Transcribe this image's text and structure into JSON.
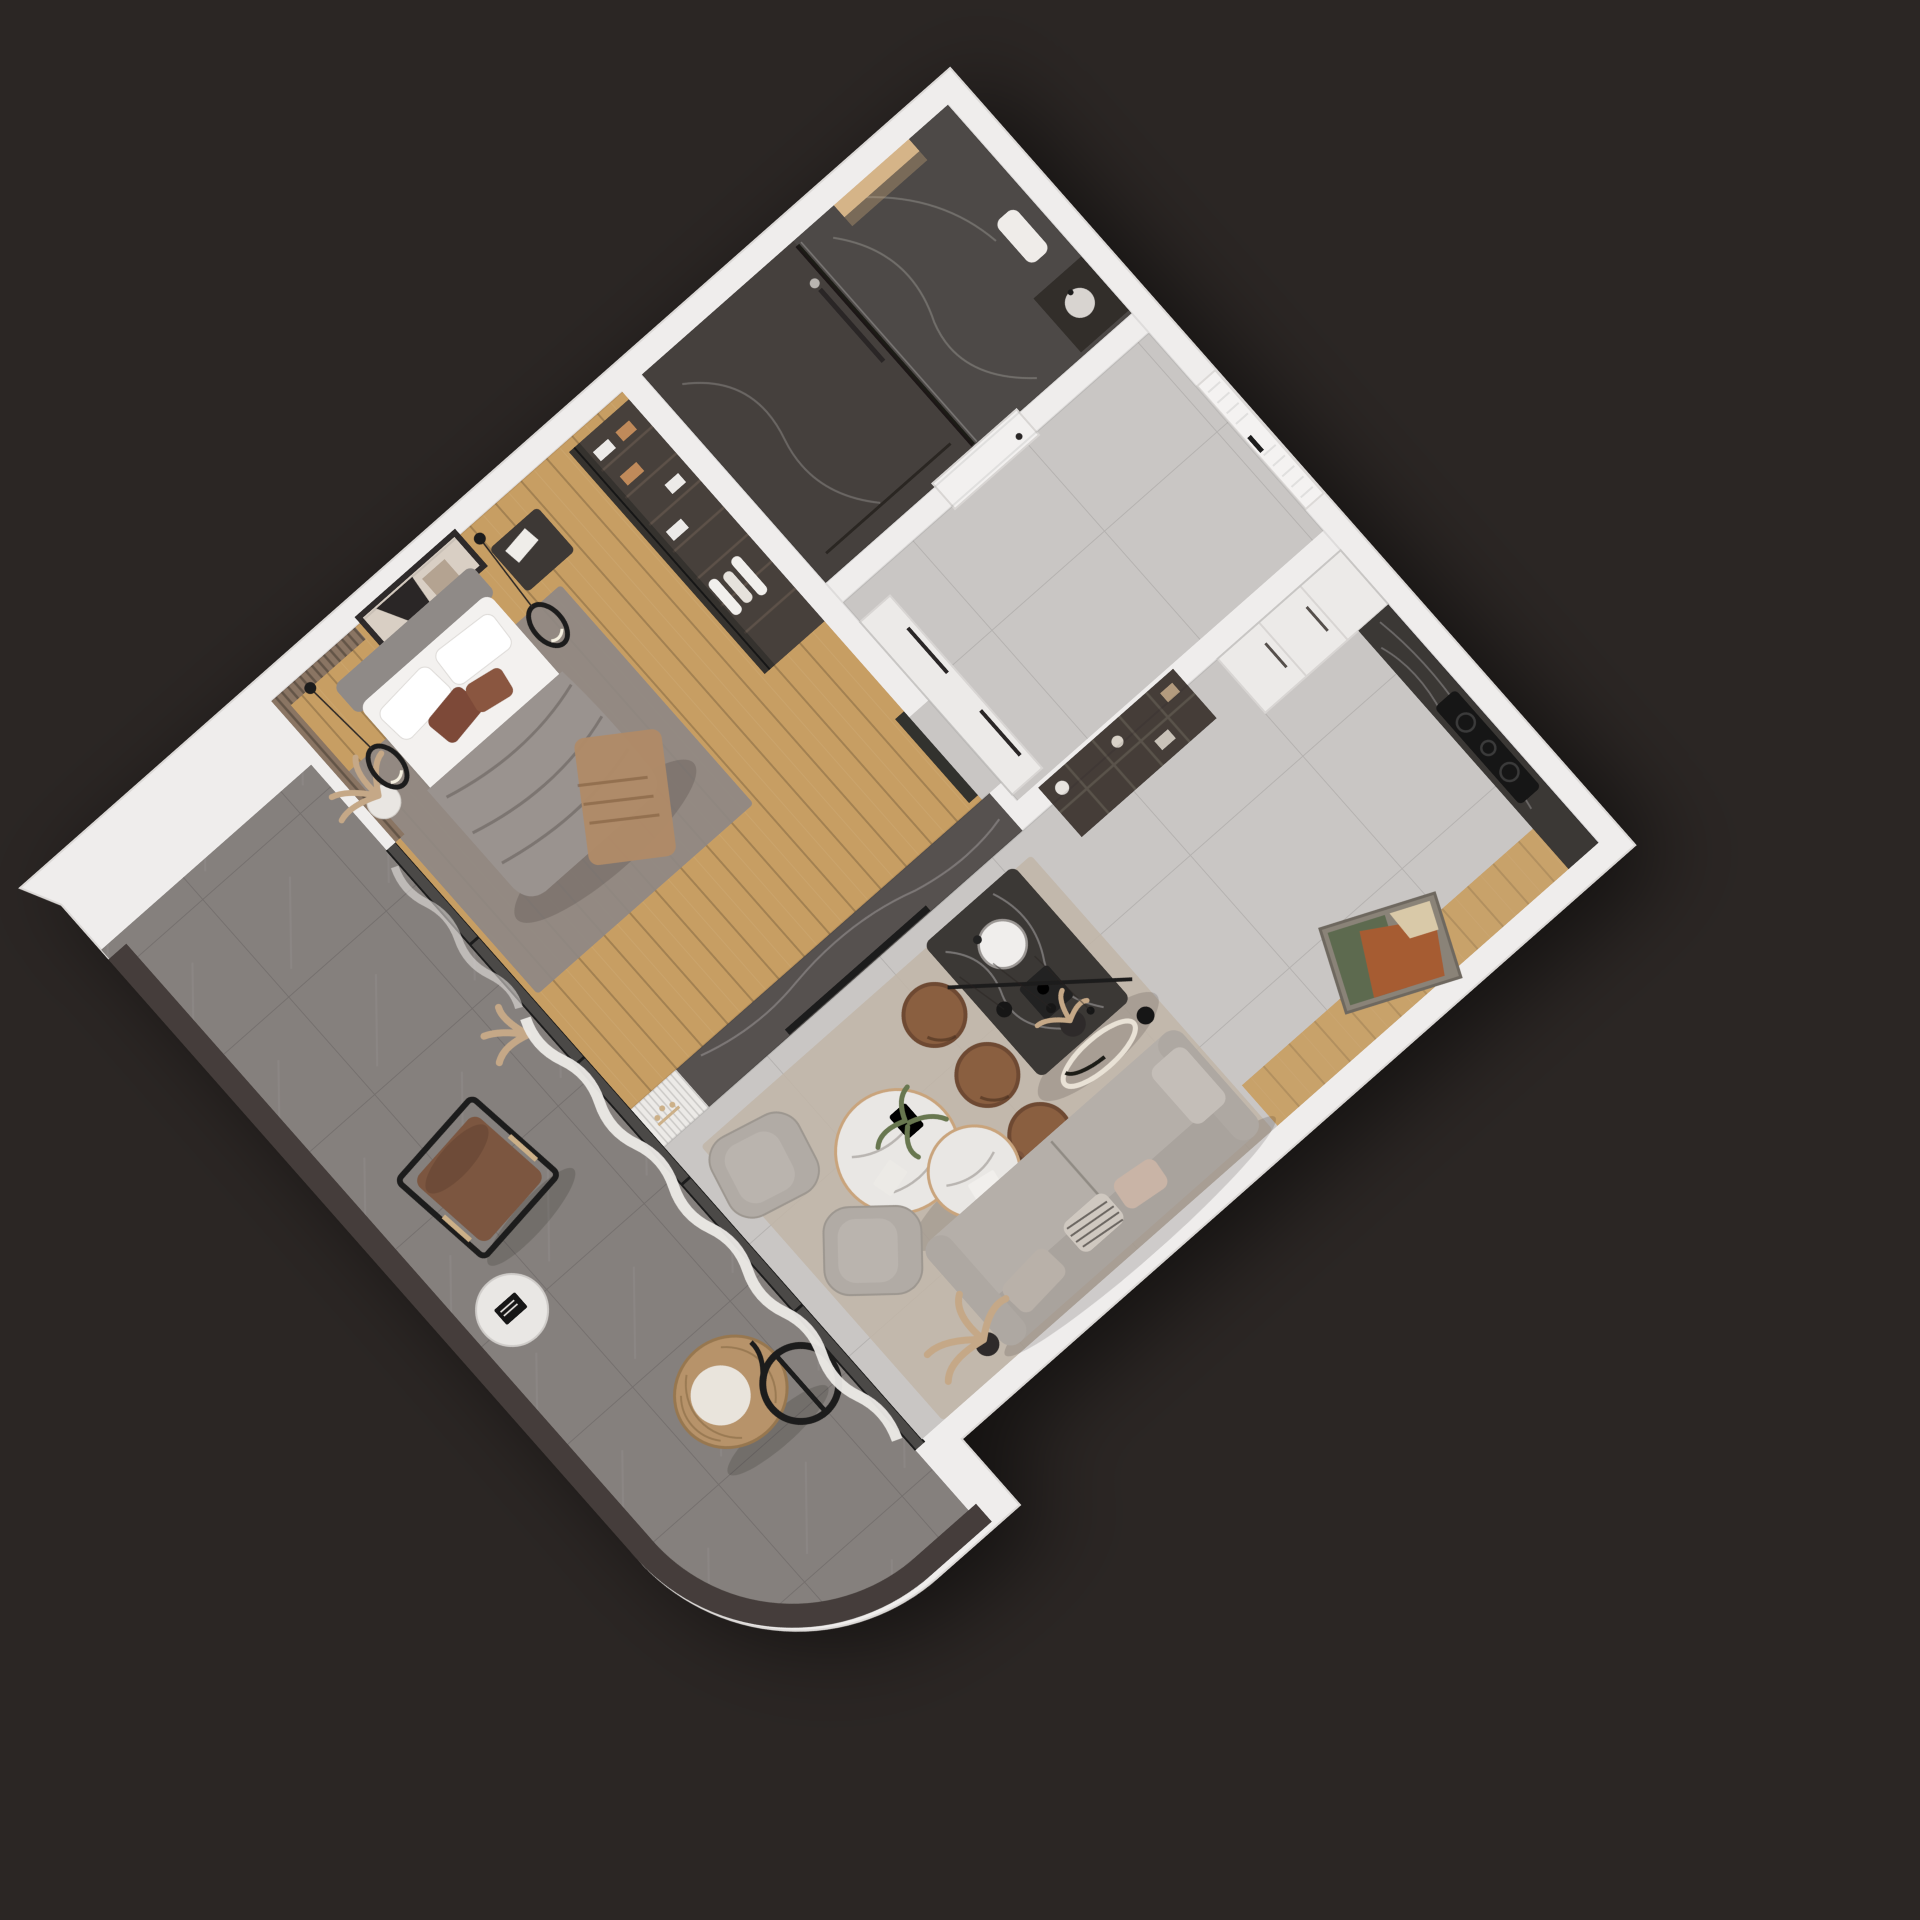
{
  "scene": {
    "kind": "3d-floorplan-render",
    "view": "top-down axonometric, rotated",
    "rotation_deg": -41.4
  },
  "palette": {
    "background": "#2b2624",
    "wall": "#efedec",
    "wallEdge": "#d9d6d4",
    "floorTile": "#c9c6c4",
    "floorWood": "#c79e63",
    "woodStrip": "#c8a26a",
    "floorStone": "#85807d",
    "parapet": "#443d3a",
    "marbleBathroom": "#4e4a47",
    "showerFloor": "#45403d",
    "marbleIsland": "#3b3735",
    "marbleTvWall": "#575150",
    "glass": "#35322f",
    "curtain": "#eceae7",
    "rugBedroom": "#8e8884",
    "rugLiving": "#c1b5a8",
    "bedDuvet": "#9a938f",
    "bedLinen": "#f3f1ef",
    "headboard": "#8f8a87",
    "pillowAccent": "#7d4a38",
    "throw": "#b08a67",
    "sofa": "#b5afa9",
    "sofaBack": "#a9a39d",
    "armchair": "#b1aba5",
    "wardrobe": "#47403b",
    "stool": "#8a5e41",
    "leather": "#7b5640",
    "rattan": "#b7936a",
    "eggCushion": "#e9e4dc",
    "tableMarble": "#e9e7e4",
    "metalBlack": "#1d1b1a",
    "brass": "#ccb088",
    "plant": "#68774f",
    "pampas": "#c5a887",
    "paintingRust": "#a65b33",
    "paintingGreen": "#5d6b50",
    "paintingCream": "#d9c9a8",
    "nicheLight": "#d5b488",
    "tvCabinet": "#8f8a85",
    "shelfUnit": "#453e39",
    "cooktop": "#151414",
    "cabinetWhite": "#eceae8",
    "closetWhite": "#edebе9",
    "nightstand": "#3c3734",
    "artFrame": "#2f2c2a",
    "artMat": "#d9cfc4",
    "slatWood": "#8a7563"
  },
  "rooms": [
    {
      "id": "bathroom",
      "label": "Bathroom"
    },
    {
      "id": "entry-hall",
      "label": "Entry hall"
    },
    {
      "id": "bedroom",
      "label": "Bedroom"
    },
    {
      "id": "living-kitchen",
      "label": "Living room + kitchen"
    },
    {
      "id": "balcony",
      "label": "Balcony"
    }
  ],
  "furniture": {
    "bedroom": [
      "wardrobe with glass doors",
      "double bed",
      "nightstand",
      "abstract wall art",
      "pendant ring lights",
      "pampas vase",
      "gray rug",
      "wood slat panel"
    ],
    "living": [
      "tv marble wall",
      "fluted panel with driftwood",
      "open shelving unit",
      "kitchen island with sink",
      "3 leather bar stools",
      "pendant cluster light",
      "wall counter with cooktop",
      "tall white cabinets",
      "gray sofa with pillows",
      "two round marble coffee tables",
      "two armchairs",
      "leaning abstract painting",
      "beige rug",
      "pampas plant"
    ],
    "balcony": [
      "curved parapet",
      "leather lounge chair",
      "round side table with book",
      "hanging rattan egg chair",
      "sheer curtains"
    ],
    "bathroom": [
      "glass shower partition",
      "backlit niche",
      "towel",
      "dark vanity"
    ],
    "hall": [
      "entry door",
      "bathroom door",
      "white closet"
    ]
  }
}
